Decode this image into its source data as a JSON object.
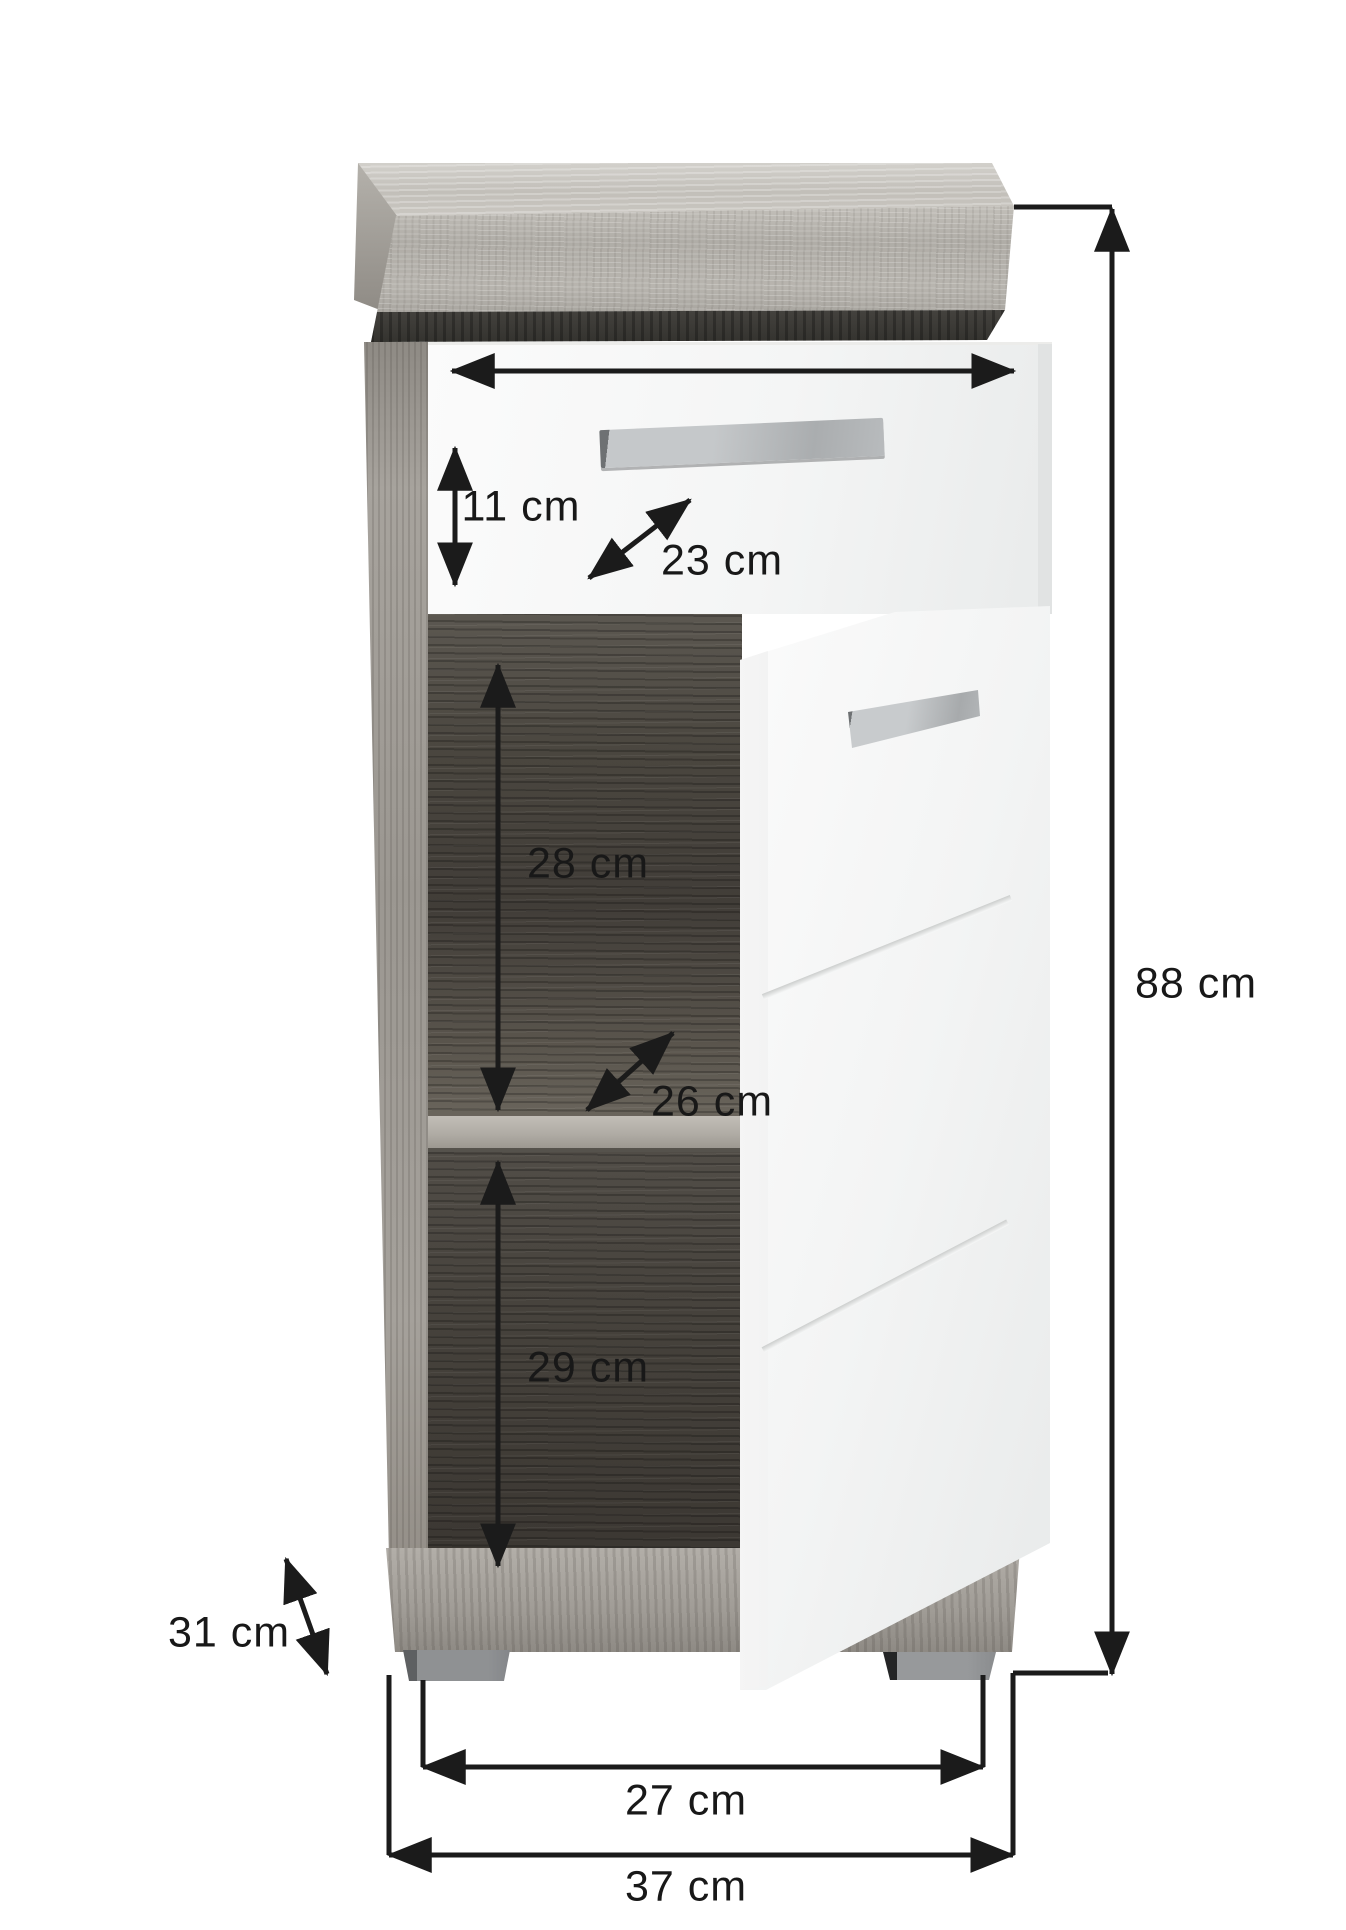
{
  "diagram": {
    "type": "furniture-dimension-diagram",
    "subject": "bathroom floor cabinet with top drawer and open door showing two shelf compartments",
    "background_color": "#ffffff",
    "dimension_line_color": "#1b1b1b",
    "measurements": {
      "drawer_front_height": "11 cm",
      "drawer_depth": "23 cm",
      "upper_compartment_height": "28 cm",
      "shelf_depth": "26 cm",
      "lower_compartment_height": "29 cm",
      "total_height": "88 cm",
      "total_depth": "31 cm",
      "feet_span_width": "27 cm",
      "total_width": "37 cm"
    },
    "materials": {
      "frame_wood_hex": "#b2afa9",
      "interior_wood_hex": "#46423c",
      "front_panel_hex": "#f4f5f5",
      "handle_hex": "#b4b7b9",
      "feet_hex": "#8f9193",
      "accent_strip_hex": "#3a3834"
    }
  }
}
